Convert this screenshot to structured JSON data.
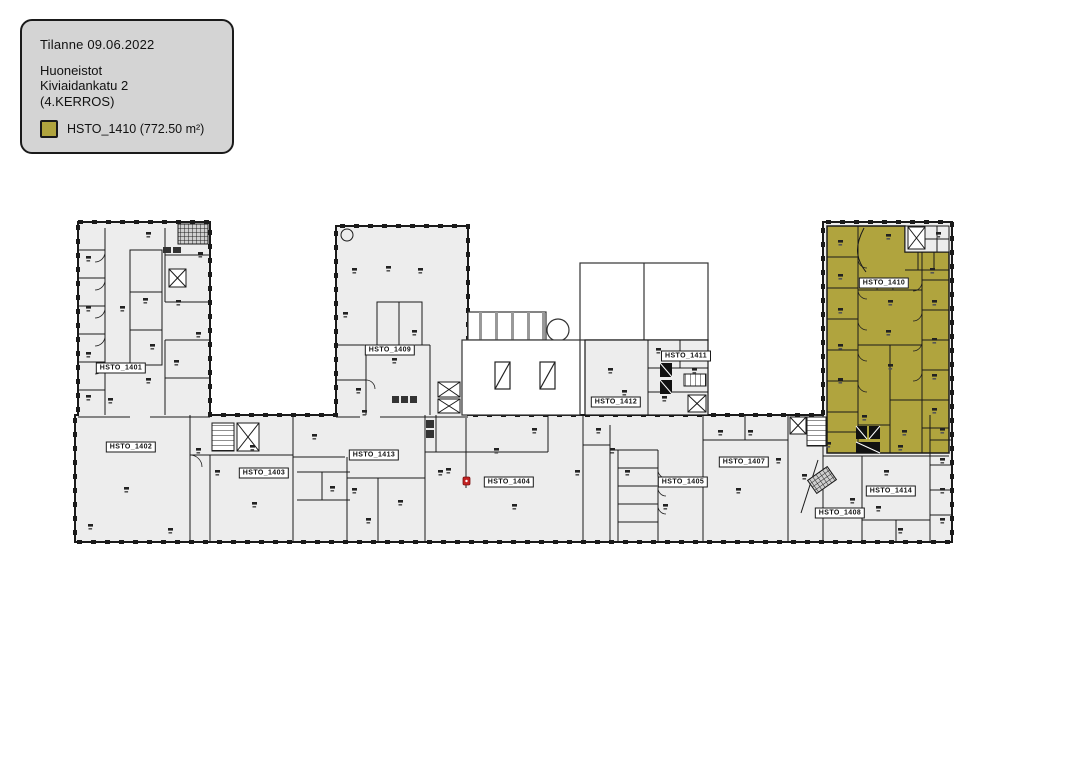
{
  "legend": {
    "title": "Tilanne 09.06.2022",
    "lines": [
      "Huoneistot",
      "Kiviaidankatu 2",
      "(4.KERROS)"
    ],
    "highlight_label": "HSTO_1410 (772.50 m²)",
    "highlight_color": "#b0a43e"
  },
  "plan": {
    "highlighted_unit": "HSTO_1410",
    "floor_color": "#ededed",
    "wall_color": "#1a1a1a",
    "units": [
      {
        "label": "HSTO_1401",
        "x": 121,
        "y": 368
      },
      {
        "label": "HSTO_1402",
        "x": 131,
        "y": 447
      },
      {
        "label": "HSTO_1403",
        "x": 264,
        "y": 473
      },
      {
        "label": "HSTO_1404",
        "x": 509,
        "y": 482
      },
      {
        "label": "HSTO_1405",
        "x": 683,
        "y": 482
      },
      {
        "label": "HSTO_1407",
        "x": 744,
        "y": 462
      },
      {
        "label": "HSTO_1408",
        "x": 840,
        "y": 513
      },
      {
        "label": "HSTO_1409",
        "x": 390,
        "y": 350
      },
      {
        "label": "HSTO_1410",
        "x": 884,
        "y": 283,
        "highlighted": true
      },
      {
        "label": "HSTO_1411",
        "x": 686,
        "y": 356
      },
      {
        "label": "HSTO_1412",
        "x": 616,
        "y": 402
      },
      {
        "label": "HSTO_1413",
        "x": 374,
        "y": 455
      },
      {
        "label": "HSTO_1414",
        "x": 891,
        "y": 491
      }
    ]
  }
}
